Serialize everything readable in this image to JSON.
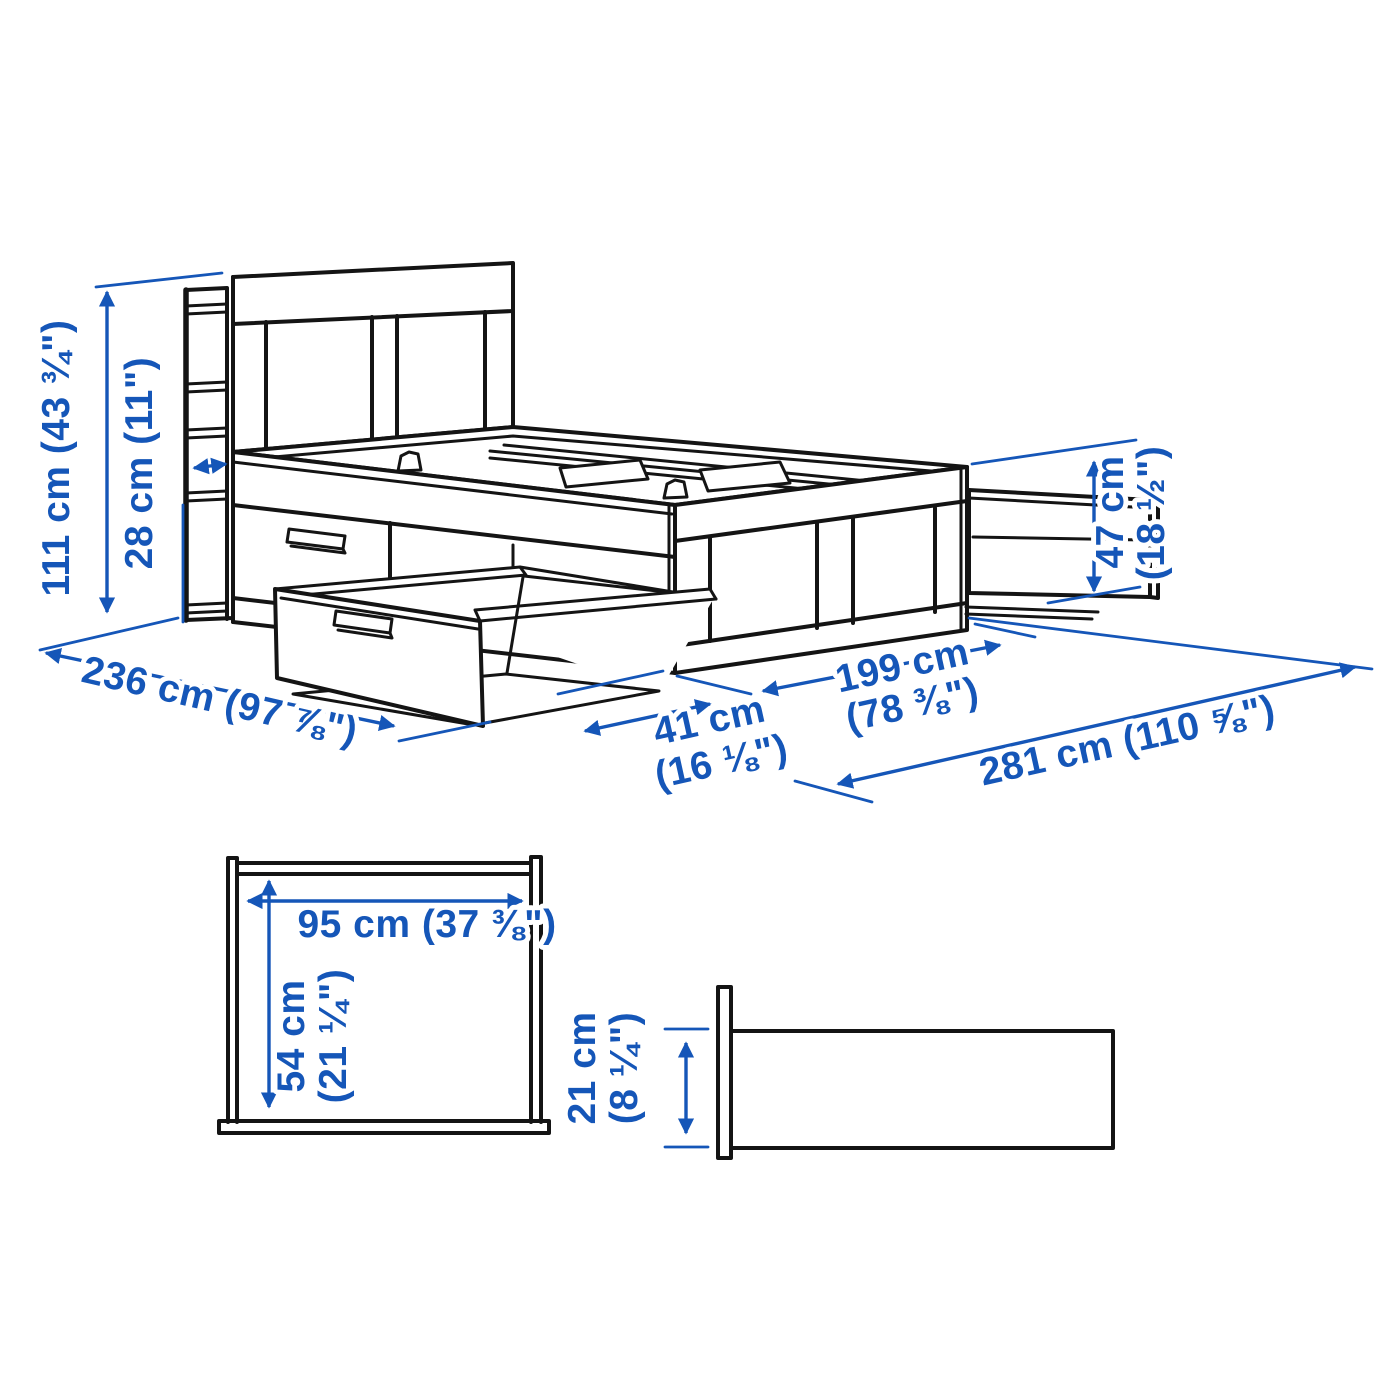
{
  "colors": {
    "dimension_blue": "#1556b8",
    "line_black": "#141414",
    "background": "#ffffff"
  },
  "views": {
    "perspective": {
      "description": "bed frame with storage headboard, one side drawer and one foot-end drawer pulled out",
      "dimensions": {
        "headboard_height": "111 cm (43 ¾\")",
        "headboard_shelf_depth": "28 cm (11\")",
        "total_length": "236 cm (97 ⅞\")",
        "drawer_pullout_line1": "41 cm",
        "drawer_pullout_line2": "(16 ⅛\")",
        "width_span_line1": "199 cm",
        "width_span_line2": "(78 ⅜\")",
        "total_width_drawers_open": "281 cm (110 ⅝\")",
        "foot_height_line1": "47 cm",
        "foot_height_line2": "(18 ½\")"
      }
    },
    "cross_section": {
      "description": "storage drawer opening cross-section",
      "inner_width": "95 cm (37 ⅜\")",
      "inner_height_line1": "54 cm",
      "inner_height_line2": "(21 ¼\")"
    },
    "rail_profile": {
      "description": "drawer / side rail profile",
      "height_line1": "21 cm",
      "height_line2": "(8 ¼\")"
    }
  }
}
